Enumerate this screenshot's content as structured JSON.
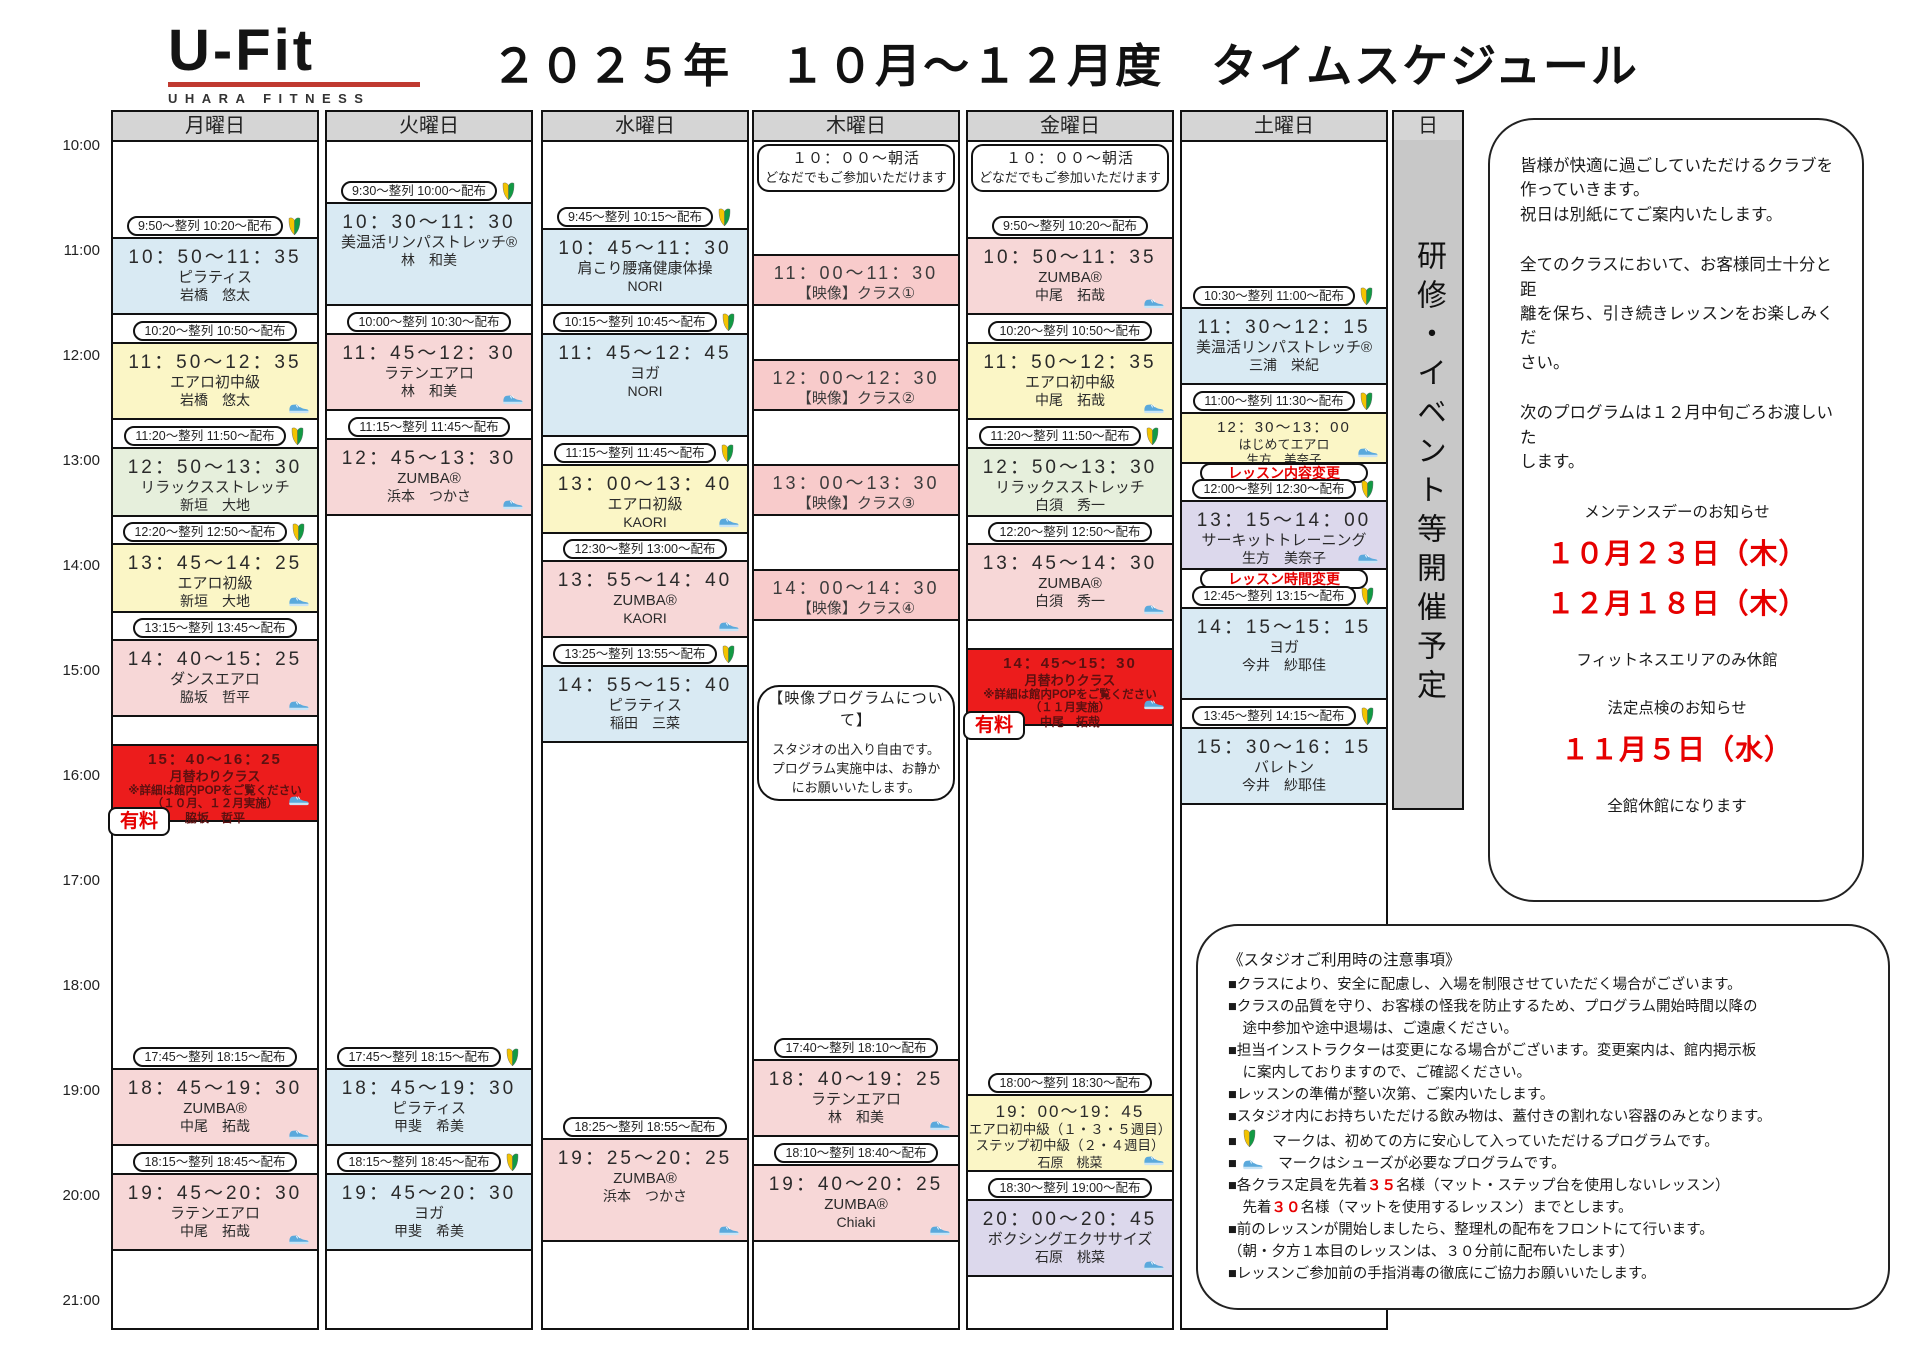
{
  "logo": {
    "brand": "U-Fit",
    "sub": "UHARA FITNESS"
  },
  "title": "２０２５年　１０月～１２月度　タイムスケジュール",
  "colors": {
    "blue": "#d9eaf3",
    "pink": "#f7d7d7",
    "video": "#f8cbcb",
    "yellow": "#fbf6c6",
    "green": "#e6efdc",
    "lavender": "#dcd8ec",
    "red": "#ec1c1c",
    "paid_text": "#e60000",
    "date_red": "#e60000",
    "change_label_text": "#e60000",
    "header_gray": "#d5d5d5",
    "sunday_gray": "#c8c8c8",
    "logo_underline": "#c03a30"
  },
  "time_axis": {
    "start_y": 147,
    "hour_height": 105,
    "labels": [
      "10:00",
      "11:00",
      "12:00",
      "13:00",
      "14:00",
      "15:00",
      "16:00",
      "17:00",
      "18:00",
      "19:00",
      "20:00",
      "21:00"
    ]
  },
  "days": [
    {
      "id": "monday",
      "label": "月曜日",
      "left": 111,
      "width": 208,
      "classes": [
        {
          "badge": "9:50～整列 10:20～配布",
          "beginner": true,
          "top": 235,
          "height": 78,
          "time": "10：50～11：35",
          "name": "ピラティス",
          "instructor": "岩橋　悠太",
          "color": "blue",
          "shoe": false
        },
        {
          "badge": "10:20～整列 10:50～配布",
          "beginner": false,
          "top": 340,
          "height": 78,
          "time": "11：50～12：35",
          "name": "エアロ初中級",
          "instructor": "岩橋　悠太",
          "color": "yellow",
          "shoe": true
        },
        {
          "badge": "11:20～整列 11:50～配布",
          "beginner": true,
          "top": 445,
          "height": 70,
          "time": "12：50～13：30",
          "name": "リラックスストレッチ",
          "instructor": "新垣　大地",
          "color": "green",
          "shoe": false
        },
        {
          "badge": "12:20～整列 12:50～配布",
          "beginner": true,
          "top": 541,
          "height": 70,
          "time": "13：45～14：25",
          "name": "エアロ初級",
          "instructor": "新垣　大地",
          "color": "yellow",
          "shoe": true
        },
        {
          "badge": "13:15～整列 13:45～配布",
          "beginner": false,
          "top": 637,
          "height": 78,
          "time": "14：40～15：25",
          "name": "ダンスエアロ",
          "instructor": "脇坂　哲平",
          "color": "pink",
          "shoe": true
        },
        {
          "top": 742,
          "height": 78,
          "time": "15：40～16：25",
          "name": "月替わりクラス",
          "note_lines": [
            "※詳細は館内POPをご覧ください",
            "（１０月、１２月実施）"
          ],
          "instructor": "脇坂　哲平",
          "color": "red",
          "shoe": true,
          "paid": "有料"
        },
        {
          "badge": "17:45～整列 18:15～配布",
          "beginner": false,
          "top": 1066,
          "height": 78,
          "time": "18：45～19：30",
          "name": "ZUMBA®",
          "instructor": "中尾　拓哉",
          "color": "pink",
          "shoe": true
        },
        {
          "badge": "18:15～整列 18:45～配布",
          "beginner": false,
          "top": 1171,
          "height": 78,
          "time": "19：45～20：30",
          "name": "ラテンエアロ",
          "instructor": "中尾　拓哉",
          "color": "pink",
          "shoe": true
        }
      ]
    },
    {
      "id": "tuesday",
      "label": "火曜日",
      "left": 325,
      "width": 208,
      "classes": [
        {
          "badge": "9:30～整列 10:00～配布",
          "beginner": true,
          "top": 200,
          "height": 104,
          "time": "10：30～11：30",
          "name": "美温活リンパストレッチ®",
          "instructor": "林　和美",
          "color": "blue",
          "shoe": false
        },
        {
          "badge": "10:00～整列 10:30～配布",
          "beginner": false,
          "top": 331,
          "height": 78,
          "time": "11：45～12：30",
          "name": "ラテンエアロ",
          "instructor": "林　和美",
          "color": "pink",
          "shoe": true
        },
        {
          "badge": "11:15～整列 11:45～配布",
          "beginner": false,
          "top": 436,
          "height": 78,
          "time": "12：45～13：30",
          "name": "ZUMBA®",
          "instructor": "浜本　つかさ",
          "color": "pink",
          "shoe": true
        },
        {
          "badge": "17:45～整列 18:15～配布",
          "beginner": true,
          "top": 1066,
          "height": 78,
          "time": "18：45～19：30",
          "name": "ピラティス",
          "instructor": "甲斐　希美",
          "color": "blue",
          "shoe": false
        },
        {
          "badge": "18:15～整列 18:45～配布",
          "beginner": true,
          "top": 1171,
          "height": 78,
          "time": "19：45～20：30",
          "name": "ヨガ",
          "instructor": "甲斐　希美",
          "color": "blue",
          "shoe": false
        }
      ]
    },
    {
      "id": "wednesday",
      "label": "水曜日",
      "left": 541,
      "width": 208,
      "classes": [
        {
          "badge": "9:45～整列 10:15～配布",
          "beginner": true,
          "top": 226,
          "height": 78,
          "time": "10：45～11：30",
          "name": "肩こり腰痛健康体操",
          "instructor": "NORI",
          "color": "blue",
          "shoe": false
        },
        {
          "badge": "10:15～整列 10:45～配布",
          "beginner": true,
          "top": 331,
          "height": 104,
          "time": "11：45～12：45",
          "name": "ヨガ",
          "instructor": "NORI",
          "color": "blue",
          "shoe": false
        },
        {
          "badge": "11:15～整列 11:45～配布",
          "beginner": true,
          "top": 462,
          "height": 70,
          "time": "13：00～13：40",
          "name": "エアロ初級",
          "instructor": "KAORI",
          "color": "yellow",
          "shoe": true
        },
        {
          "badge": "12:30～整列 13:00～配布",
          "beginner": false,
          "top": 558,
          "height": 78,
          "time": "13：55～14：40",
          "name": "ZUMBA®",
          "instructor": "KAORI",
          "color": "pink",
          "shoe": true
        },
        {
          "badge": "13:25～整列 13:55～配布",
          "beginner": true,
          "top": 663,
          "height": 78,
          "time": "14：55～15：40",
          "name": "ピラティス",
          "instructor": "稲田　三菜",
          "color": "blue",
          "shoe": false
        },
        {
          "badge": "18:25～整列 18:55～配布",
          "beginner": false,
          "top": 1136,
          "height": 104,
          "time": "19：25～20：25",
          "name": "ZUMBA®",
          "instructor": "浜本　つかさ",
          "color": "pink",
          "shoe": true
        }
      ]
    },
    {
      "id": "thursday",
      "label": "木曜日",
      "left": 752,
      "width": 208,
      "boxes": [
        {
          "name": "morning-activity-box",
          "radius": 12,
          "top": 142,
          "height": 48,
          "lines": [
            "１０：００～朝活",
            "どなだでもご参加いただけます"
          ]
        },
        {
          "name": "video-program-box",
          "radius": 22,
          "top": 683,
          "height": 116,
          "lines": [
            "【映像プログラムについて】",
            "",
            "スタジオの出入り自由です。",
            "プログラム実施中は、お静か",
            "にお願いいたします。"
          ]
        }
      ],
      "classes": [
        {
          "top": 252,
          "height": 52,
          "time": "11：00～11：30",
          "name": "【映像】クラス①",
          "color": "video"
        },
        {
          "top": 357,
          "height": 52,
          "time": "12：00～12：30",
          "name": "【映像】クラス②",
          "color": "video"
        },
        {
          "top": 462,
          "height": 52,
          "time": "13：00～13：30",
          "name": "【映像】クラス③",
          "color": "video"
        },
        {
          "top": 567,
          "height": 52,
          "time": "14：00～14：30",
          "name": "【映像】クラス④",
          "color": "video"
        },
        {
          "badge": "17:40～整列 18:10～配布",
          "beginner": false,
          "top": 1057,
          "height": 78,
          "time": "18：40～19：25",
          "name": "ラテンエアロ",
          "instructor": "林　和美",
          "color": "pink",
          "shoe": true
        },
        {
          "badge": "18:10～整列 18:40～配布",
          "beginner": false,
          "top": 1162,
          "height": 78,
          "time": "19：40～20：25",
          "name": "ZUMBA®",
          "instructor": "Chiaki",
          "color": "pink",
          "shoe": true
        }
      ]
    },
    {
      "id": "friday",
      "label": "金曜日",
      "left": 966,
      "width": 208,
      "boxes": [
        {
          "name": "morning-activity-box",
          "radius": 12,
          "top": 142,
          "height": 48,
          "lines": [
            "１０：００～朝活",
            "どなだでもご参加いただけます"
          ]
        }
      ],
      "classes": [
        {
          "badge": "9:50～整列 10:20～配布",
          "beginner": false,
          "top": 235,
          "height": 78,
          "time": "10：50～11：35",
          "name": "ZUMBA®",
          "instructor": "中尾　拓哉",
          "color": "pink",
          "shoe": true
        },
        {
          "badge": "10:20～整列 10:50～配布",
          "beginner": false,
          "top": 340,
          "height": 78,
          "time": "11：50～12：35",
          "name": "エアロ初中級",
          "instructor": "中尾　拓哉",
          "color": "yellow",
          "shoe": true
        },
        {
          "badge": "11:20～整列 11:50～配布",
          "beginner": true,
          "top": 445,
          "height": 70,
          "time": "12：50～13：30",
          "name": "リラックスストレッチ",
          "instructor": "白須　秀一",
          "color": "green",
          "shoe": false
        },
        {
          "badge": "12:20～整列 12:50～配布",
          "beginner": false,
          "top": 541,
          "height": 78,
          "time": "13：45～14：30",
          "name": "ZUMBA®",
          "instructor": "白須　秀一",
          "color": "pink",
          "shoe": true
        },
        {
          "top": 646,
          "height": 78,
          "time": "14：45～15：30",
          "name": "月替わりクラス",
          "note_lines": [
            "※詳細は館内POPをご覧ください",
            "（１１月実施）"
          ],
          "instructor": "中尾　拓哉",
          "color": "red",
          "shoe": true,
          "paid": "有料"
        },
        {
          "badge": "18:00～整列 18:30～配布",
          "beginner": false,
          "top": 1092,
          "height": 78,
          "time": "19：00～19：45",
          "name": "エアロ初中級（１・３・５週目）",
          "name2": "ステップ初中級（２・４週目）",
          "instructor": "石原　桃菜",
          "color": "yellow",
          "shoe": true
        },
        {
          "badge": "18:30～整列 19:00～配布",
          "beginner": false,
          "top": 1197,
          "height": 78,
          "time": "20：00～20：45",
          "name": "ボクシングエクササイズ",
          "instructor": "石原　桃菜",
          "color": "lavender",
          "shoe": true
        }
      ]
    },
    {
      "id": "saturday",
      "label": "土曜日",
      "left": 1180,
      "width": 208,
      "classes": [
        {
          "badge": "10:30～整列 11:00～配布",
          "beginner": true,
          "top": 305,
          "height": 78,
          "time": "11：30～12：15",
          "name": "美温活リンパストレッチ®",
          "instructor": "三浦　栄紀",
          "color": "blue",
          "shoe": false
        },
        {
          "badge": "11:00～整列 11:30～配布",
          "beginner": true,
          "top": 410,
          "height": 52,
          "time": "12：30～13：00",
          "name": "はじめてエアロ",
          "instructor": "生方　美奈子",
          "color": "yellow",
          "shoe": true,
          "label_below": "レッスン内容変更"
        },
        {
          "badge": "12:00～整列 12:30～配布",
          "beginner": true,
          "top": 498,
          "height": 70,
          "time": "13：15～14：00",
          "name": "サーキットトレーニング",
          "instructor": "生方　美奈子",
          "color": "lavender",
          "shoe": true,
          "label_below": "レッスン時間変更"
        },
        {
          "badge": "12:45～整列 13:15～配布",
          "beginner": true,
          "top": 605,
          "height": 93,
          "time": "14：15～15：15",
          "name": "ヨガ",
          "instructor": "今井　紗耶佳",
          "color": "blue",
          "shoe": false
        },
        {
          "badge": "13:45～整列 14:15～配布",
          "beginner": true,
          "top": 725,
          "height": 78,
          "time": "15：30～16：15",
          "name": "バレトン",
          "instructor": "今井　紗耶佳",
          "color": "blue",
          "shoe": false
        }
      ]
    }
  ],
  "sunday": {
    "label": "日",
    "left": 1392,
    "width": 72,
    "height": 700,
    "vertical_text": "研修・イベント等開催予定"
  },
  "info_panel": {
    "paragraphs": [
      "皆様が快適に過ごしていただけるクラブを\n作っていきます。\n祝日は別紙にてご案内いたします。",
      "全てのクラスにおいて、お客様同士十分と距\n離を保ち、引き続きレッスンをお楽しみくだ\nさい。",
      "次のプログラムは１２月中旬ごろお渡しいた\nします。"
    ],
    "maintenance_title": "メンテンスデーのお知らせ",
    "maintenance_dates": [
      "１０月２３日（木）",
      "１２月１８日（木）"
    ],
    "maintenance_note": "フィットネスエリアのみ休館",
    "inspection_title": "法定点検のお知らせ",
    "inspection_date": "１１月５日（水）",
    "inspection_note": "全館休館になります"
  },
  "notes": {
    "title": "《スタジオご利用時の注意事項》",
    "lines": [
      [
        {
          "t": "■クラスにより、安全に配慮し、入場を制限させていただく場合がございます。"
        }
      ],
      [
        {
          "t": "■クラスの品質を守り、お客様の怪我を防止するため、プログラム開始時間以降の"
        }
      ],
      [
        {
          "t": "　途中参加や途中退場は、ご遠慮ください。"
        }
      ],
      [
        {
          "t": "■担当インストラクターは変更になる場合がございます。変更案内は、館内掲示板"
        }
      ],
      [
        {
          "t": "　に案内しておりますので、ご確認ください。"
        }
      ],
      [
        {
          "t": "■レッスンの準備が整い次第、ご案内いたします。"
        }
      ],
      [
        {
          "t": "■スタジオ内にお持ちいただける飲み物は、蓋付きの割れない容器のみとなります。"
        }
      ],
      [
        {
          "t": "■ "
        },
        {
          "icon": "beginner"
        },
        {
          "t": "　マークは、初めての方に安心して入っていただけるプログラムです。"
        }
      ],
      [
        {
          "t": "■ "
        },
        {
          "icon": "shoe"
        },
        {
          "t": "　マークはシューズが必要なプログラムです。"
        }
      ],
      [
        {
          "t": "■各クラス定員を先着"
        },
        {
          "red": "３５"
        },
        {
          "t": "名様（マット・ステップ台を使用しないレッスン）"
        }
      ],
      [
        {
          "t": "　先着"
        },
        {
          "red": "３０"
        },
        {
          "t": "名様（マットを使用するレッスン）までとします。"
        }
      ],
      [
        {
          "t": "■前のレッスンが開始しましたら、整理札の配布をフロントにて行います。"
        }
      ],
      [
        {
          "t": "（朝・夕方１本目のレッスンは、３０分前に配布いたします）"
        }
      ],
      [
        {
          "t": "■レッスンご参加前の手指消毒の徹底にご協力お願いいたします。"
        }
      ]
    ]
  }
}
